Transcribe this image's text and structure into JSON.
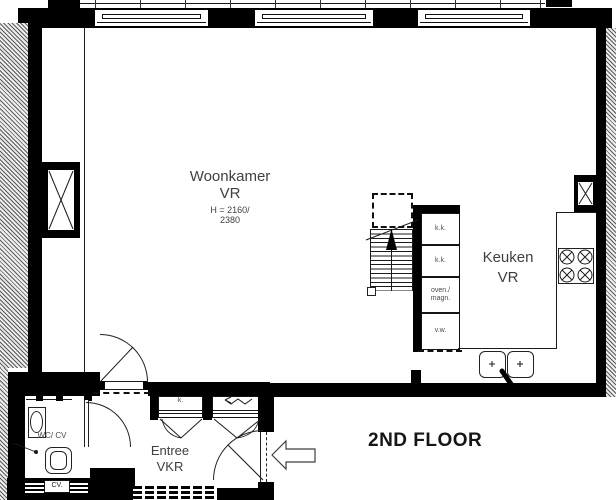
{
  "floor": {
    "title": "2ND FLOOR"
  },
  "entrance_tag": {
    "label": "32-2A"
  },
  "rooms": {
    "living": {
      "name": "Woonkamer",
      "code": "VR",
      "height_line1": "H = 2160/",
      "height_line2": "2380"
    },
    "kitchen": {
      "name": "Keuken",
      "code": "VR"
    },
    "entry": {
      "name": "Entree",
      "code": "VKR"
    },
    "wc": {
      "name": "WC/ CV"
    }
  },
  "kitchen_units": {
    "kk_top": "k.k.",
    "kk_bottom": "k.k.",
    "oven_line1": "oven./",
    "oven_line2": "magn.",
    "vw": "v.w."
  },
  "entry_units": {
    "closet": "k."
  },
  "wc_units": {
    "cv": "CV."
  },
  "colors": {
    "wall": "#000000",
    "line": "#1a1a1a",
    "label": "#3f3f3f"
  }
}
